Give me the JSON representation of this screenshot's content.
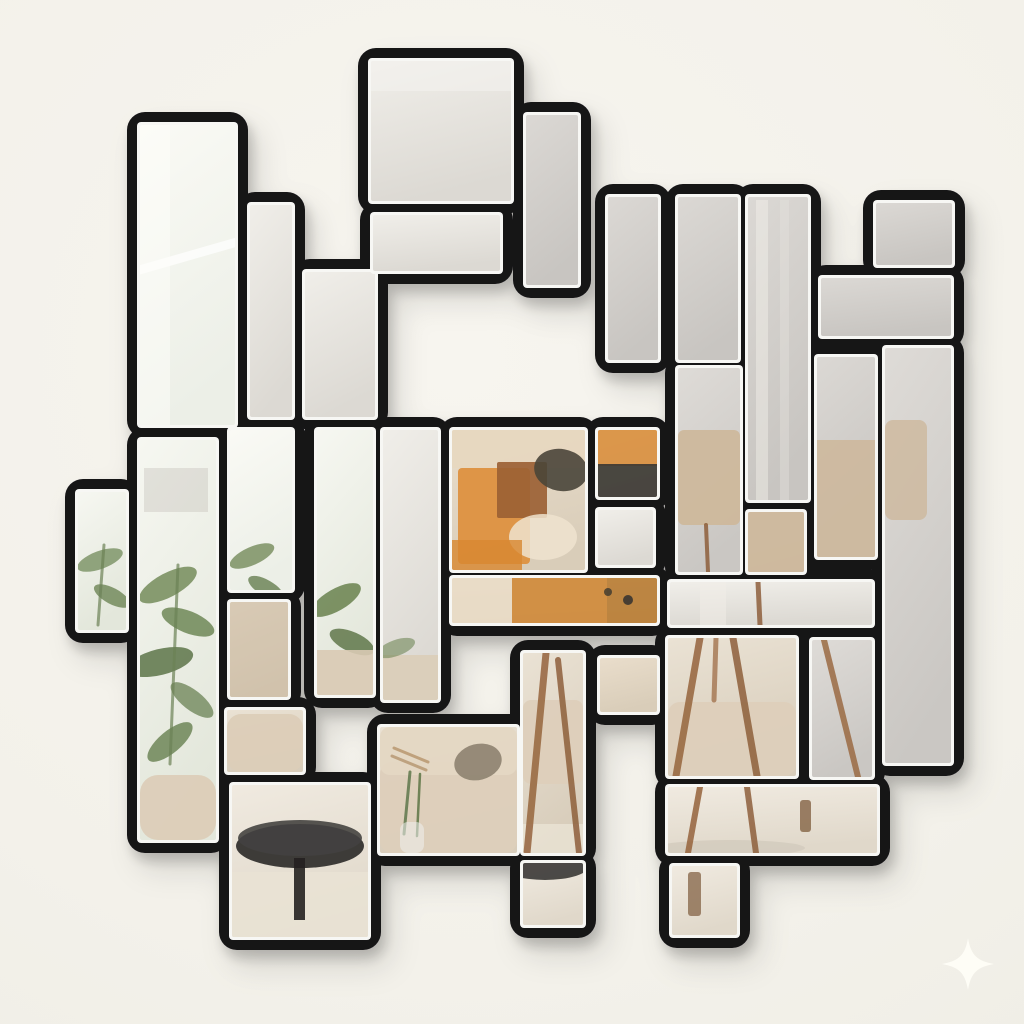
{
  "scene": {
    "description": "Tetris-style geometric wall mirror with black frames on an off-white wall, tiles reflecting a living room with plant, beige sofa, abstract orange artwork, wooden tripod floor lamp and round black coffee table",
    "wall_color": "#f3f1ea",
    "frame_color": "#141318",
    "bevel_color": "#f7f7f4",
    "shadow_color": "#000000",
    "sparkle_color": "#fffef7",
    "reflections": [
      "window light",
      "curtain",
      "city view",
      "green plant leaves",
      "beige sofa with cushions",
      "abstract orange wall art",
      "wooden tripod floor lamp with beige shade",
      "round black coffee table",
      "light wood floor and rug"
    ]
  },
  "palette": {
    "window": [
      "#fafaf5",
      "#ecefe7"
    ],
    "plantwin": [
      "#f6f7f1",
      "#e3e7db"
    ],
    "ceiling": [
      "#f0eee9",
      "#dcd9d3"
    ],
    "gray": [
      "#dbd8d4",
      "#c8c5c1"
    ],
    "lampgray": [
      "#dedbd7",
      "#cac7c3"
    ],
    "warm": [
      "#e9ddcb",
      "#d9cdb9"
    ],
    "sofa": [
      "#eae2d4",
      "#d8cdbb"
    ],
    "floor": [
      "#f0eae0",
      "#e0d8ca"
    ]
  },
  "tiles": [
    {
      "name": "tile-topleft-tall",
      "x": 140,
      "y": 125,
      "w": 95,
      "h": 300,
      "fill": "window"
    },
    {
      "name": "tile-thin-bar",
      "x": 250,
      "y": 205,
      "w": 42,
      "h": 212,
      "fill": "ceiling"
    },
    {
      "name": "tile-step-bar",
      "x": 305,
      "y": 272,
      "w": 70,
      "h": 145,
      "fill": "ceiling"
    },
    {
      "name": "tile-big-square-top",
      "x": 371,
      "y": 61,
      "w": 140,
      "h": 140,
      "fill": "ceiling"
    },
    {
      "name": "tile-horiz-under-square",
      "x": 373,
      "y": 215,
      "w": 127,
      "h": 56,
      "fill": "ceiling"
    },
    {
      "name": "tile-vert-right-of-square",
      "x": 526,
      "y": 115,
      "w": 52,
      "h": 170,
      "fill": "gray"
    },
    {
      "name": "tile-top-bar-1",
      "x": 608,
      "y": 197,
      "w": 50,
      "h": 163,
      "fill": "gray"
    },
    {
      "name": "tile-top-bar-2",
      "x": 678,
      "y": 197,
      "w": 60,
      "h": 163,
      "fill": "gray"
    },
    {
      "name": "tile-top-bar-3",
      "x": 748,
      "y": 197,
      "w": 60,
      "h": 303,
      "fill": "gray"
    },
    {
      "name": "tile-z-top-square",
      "x": 876,
      "y": 203,
      "w": 76,
      "h": 62,
      "fill": "gray"
    },
    {
      "name": "tile-z-lower-bar",
      "x": 821,
      "y": 278,
      "w": 130,
      "h": 58,
      "fill": "gray"
    },
    {
      "name": "tile-right-tall-column",
      "x": 885,
      "y": 348,
      "w": 66,
      "h": 415,
      "fill": "lampgray"
    },
    {
      "name": "tile-right-mid",
      "x": 817,
      "y": 357,
      "w": 58,
      "h": 200,
      "fill": "gray"
    },
    {
      "name": "tile-left-notch",
      "x": 78,
      "y": 492,
      "w": 48,
      "h": 138,
      "fill": "plantwin"
    },
    {
      "name": "tile-left-plant-tall",
      "x": 140,
      "y": 440,
      "w": 76,
      "h": 400,
      "fill": "plantwin"
    },
    {
      "name": "tile-left-window",
      "x": 230,
      "y": 430,
      "w": 62,
      "h": 160,
      "fill": "window"
    },
    {
      "name": "tile-plant-bar",
      "x": 317,
      "y": 430,
      "w": 56,
      "h": 265,
      "fill": "plantwin"
    },
    {
      "name": "tile-center-left-bar",
      "x": 383,
      "y": 430,
      "w": 55,
      "h": 270,
      "fill": "ceiling"
    },
    {
      "name": "tile-artwork-square",
      "x": 452,
      "y": 430,
      "w": 133,
      "h": 140,
      "fill": "warm"
    },
    {
      "name": "tile-art-right-small",
      "x": 598,
      "y": 430,
      "w": 59,
      "h": 67,
      "fill": "warm"
    },
    {
      "name": "tile-small-wall-square",
      "x": 598,
      "y": 510,
      "w": 55,
      "h": 55,
      "fill": "ceiling"
    },
    {
      "name": "tile-art-bottom-bar",
      "x": 452,
      "y": 578,
      "w": 205,
      "h": 45,
      "fill": "warm"
    },
    {
      "name": "tile-lampshade-left",
      "x": 678,
      "y": 368,
      "w": 62,
      "h": 204,
      "fill": "lampgray"
    },
    {
      "name": "tile-lampshade-small",
      "x": 748,
      "y": 512,
      "w": 56,
      "h": 60,
      "fill": "lampgray"
    },
    {
      "name": "tile-curtain-bar",
      "x": 670,
      "y": 582,
      "w": 202,
      "h": 43,
      "fill": "ceiling"
    },
    {
      "name": "tile-leather-square",
      "x": 230,
      "y": 602,
      "w": 58,
      "h": 95,
      "fill": "warm"
    },
    {
      "name": "tile-sofa-arm",
      "x": 227,
      "y": 710,
      "w": 76,
      "h": 62,
      "fill": "sofa"
    },
    {
      "name": "tile-table-square",
      "x": 232,
      "y": 785,
      "w": 136,
      "h": 152,
      "fill": "floor"
    },
    {
      "name": "tile-sofa-square",
      "x": 380,
      "y": 727,
      "w": 137,
      "h": 126,
      "fill": "sofa"
    },
    {
      "name": "tile-sofa-tripod-bar",
      "x": 523,
      "y": 653,
      "w": 60,
      "h": 200,
      "fill": "sofa"
    },
    {
      "name": "tile-floor-small-square",
      "x": 523,
      "y": 863,
      "w": 60,
      "h": 62,
      "fill": "floor"
    },
    {
      "name": "tile-leather-small",
      "x": 600,
      "y": 658,
      "w": 57,
      "h": 54,
      "fill": "warm"
    },
    {
      "name": "tile-tripod-square",
      "x": 668,
      "y": 638,
      "w": 128,
      "h": 138,
      "fill": "sofa"
    },
    {
      "name": "tile-tripod-vert",
      "x": 812,
      "y": 640,
      "w": 60,
      "h": 137,
      "fill": "lampgray"
    },
    {
      "name": "tile-floor-bar",
      "x": 668,
      "y": 787,
      "w": 209,
      "h": 66,
      "fill": "floor"
    },
    {
      "name": "tile-floor-notch",
      "x": 672,
      "y": 866,
      "w": 65,
      "h": 69,
      "fill": "floor"
    }
  ],
  "decor": [
    {
      "tile": 0,
      "kind": "rect",
      "x": 126,
      "y": 250,
      "w": 135,
      "h": 9,
      "rot": -16,
      "color": "#ffffff",
      "op": 0.7
    },
    {
      "tile": 0,
      "kind": "rect",
      "x": 140,
      "y": 125,
      "w": 30,
      "h": 300,
      "color": "#fdfdfa",
      "op": 0.5
    },
    {
      "tile": 3,
      "kind": "rect",
      "x": 371,
      "y": 61,
      "w": 140,
      "h": 30,
      "color": "#f4f2ee",
      "op": 0.6
    },
    {
      "tile": 8,
      "kind": "rect",
      "x": 756,
      "y": 200,
      "w": 12,
      "h": 300,
      "color": "#f3f1ec",
      "op": 0.45
    },
    {
      "tile": 8,
      "kind": "rect",
      "x": 780,
      "y": 200,
      "w": 9,
      "h": 300,
      "color": "#e7e4de",
      "op": 0.4
    },
    {
      "tile": 13,
      "kind": "ellipse",
      "cx": 100,
      "cy": 560,
      "rx": 24,
      "ry": 9,
      "rot": -20,
      "color": "#7f9568",
      "op": 0.85
    },
    {
      "tile": 13,
      "kind": "ellipse",
      "cx": 112,
      "cy": 596,
      "rx": 20,
      "ry": 8,
      "rot": 28,
      "color": "#6d8555",
      "op": 0.8
    },
    {
      "tile": 13,
      "kind": "line",
      "x1": 104,
      "y1": 545,
      "x2": 98,
      "y2": 625,
      "w": 3,
      "color": "#6c8256",
      "op": 0.7
    },
    {
      "tile": 14,
      "kind": "rect",
      "x": 144,
      "y": 468,
      "w": 64,
      "h": 44,
      "color": "#b6b1a8",
      "op": 0.3
    },
    {
      "tile": 14,
      "kind": "ellipse",
      "cx": 168,
      "cy": 585,
      "rx": 32,
      "ry": 12,
      "rot": -28,
      "color": "#7b9163",
      "op": 0.9
    },
    {
      "tile": 14,
      "kind": "ellipse",
      "cx": 188,
      "cy": 622,
      "rx": 28,
      "ry": 11,
      "rot": 22,
      "color": "#6f8757",
      "op": 0.85
    },
    {
      "tile": 14,
      "kind": "ellipse",
      "cx": 160,
      "cy": 662,
      "rx": 34,
      "ry": 13,
      "rot": -14,
      "color": "#5d744a",
      "op": 0.85
    },
    {
      "tile": 14,
      "kind": "ellipse",
      "cx": 192,
      "cy": 700,
      "rx": 26,
      "ry": 10,
      "rot": 38,
      "color": "#72885c",
      "op": 0.8
    },
    {
      "tile": 14,
      "kind": "ellipse",
      "cx": 170,
      "cy": 742,
      "rx": 28,
      "ry": 11,
      "rot": -40,
      "color": "#66804f",
      "op": 0.8
    },
    {
      "tile": 14,
      "kind": "line",
      "x1": 178,
      "y1": 565,
      "x2": 170,
      "y2": 764,
      "w": 3,
      "color": "#6c8256",
      "op": 0.7
    },
    {
      "tile": 14,
      "kind": "rect",
      "x": 140,
      "y": 775,
      "w": 76,
      "h": 65,
      "rx": 18,
      "color": "#dccdb8",
      "op": 0.95
    },
    {
      "tile": 15,
      "kind": "ellipse",
      "cx": 252,
      "cy": 556,
      "rx": 24,
      "ry": 9,
      "rot": -24,
      "color": "#7b9163",
      "op": 0.85
    },
    {
      "tile": 15,
      "kind": "ellipse",
      "cx": 266,
      "cy": 588,
      "rx": 20,
      "ry": 8,
      "rot": 30,
      "color": "#667e50",
      "op": 0.8
    },
    {
      "tile": 16,
      "kind": "ellipse",
      "cx": 336,
      "cy": 600,
      "rx": 28,
      "ry": 11,
      "rot": -30,
      "color": "#6f8757",
      "op": 0.9
    },
    {
      "tile": 16,
      "kind": "ellipse",
      "cx": 352,
      "cy": 642,
      "rx": 24,
      "ry": 10,
      "rot": 24,
      "color": "#5f774b",
      "op": 0.85
    },
    {
      "tile": 16,
      "kind": "rect",
      "x": 317,
      "y": 650,
      "w": 56,
      "h": 45,
      "color": "#d9cab4",
      "op": 0.9
    },
    {
      "tile": 17,
      "kind": "rect",
      "x": 383,
      "y": 655,
      "w": 55,
      "h": 45,
      "color": "#dbccb6",
      "op": 0.85
    },
    {
      "tile": 17,
      "kind": "ellipse",
      "cx": 396,
      "cy": 648,
      "rx": 20,
      "ry": 8,
      "rot": -20,
      "color": "#6f8757",
      "op": 0.6
    },
    {
      "tile": 18,
      "kind": "rect",
      "x": 452,
      "y": 430,
      "w": 133,
      "h": 38,
      "color": "#e7d7bf",
      "op": 0.9
    },
    {
      "tile": 18,
      "kind": "rect",
      "x": 458,
      "y": 468,
      "w": 72,
      "h": 96,
      "rx": 4,
      "color": "#dd9140",
      "op": 0.95
    },
    {
      "tile": 18,
      "kind": "rect",
      "x": 497,
      "y": 462,
      "w": 50,
      "h": 56,
      "rx": 2,
      "color": "#9a5f33",
      "op": 0.9
    },
    {
      "tile": 18,
      "kind": "ellipse",
      "cx": 561,
      "cy": 470,
      "rx": 27,
      "ry": 21,
      "rot": 10,
      "color": "#4a4539",
      "op": 0.9
    },
    {
      "tile": 18,
      "kind": "ellipse",
      "cx": 543,
      "cy": 537,
      "rx": 34,
      "ry": 23,
      "color": "#efe3cf",
      "op": 0.85
    },
    {
      "tile": 18,
      "kind": "rect",
      "x": 452,
      "y": 540,
      "w": 70,
      "h": 30,
      "color": "#d8872f",
      "op": 0.8
    },
    {
      "tile": 19,
      "kind": "rect",
      "x": 598,
      "y": 430,
      "w": 59,
      "h": 36,
      "color": "#d98f3e",
      "op": 0.9
    },
    {
      "tile": 19,
      "kind": "rect",
      "x": 598,
      "y": 464,
      "w": 59,
      "h": 33,
      "color": "#3d3a34",
      "op": 0.92
    },
    {
      "tile": 21,
      "kind": "rect",
      "x": 452,
      "y": 578,
      "w": 60,
      "h": 45,
      "color": "#e9dcc6",
      "op": 0.9
    },
    {
      "tile": 21,
      "kind": "rect",
      "x": 512,
      "y": 578,
      "w": 95,
      "h": 45,
      "color": "#cf8a3a",
      "op": 0.92
    },
    {
      "tile": 21,
      "kind": "rect",
      "x": 607,
      "y": 578,
      "w": 50,
      "h": 45,
      "color": "#b87c34",
      "op": 0.9
    },
    {
      "tile": 21,
      "kind": "ellipse",
      "cx": 628,
      "cy": 600,
      "rx": 5,
      "ry": 5,
      "color": "#3a362f",
      "op": 0.9
    },
    {
      "tile": 21,
      "kind": "ellipse",
      "cx": 608,
      "cy": 592,
      "rx": 4,
      "ry": 4,
      "color": "#3a362f",
      "op": 0.8
    },
    {
      "tile": 22,
      "kind": "rect",
      "x": 678,
      "y": 430,
      "w": 62,
      "h": 95,
      "rx": 6,
      "color": "#cdb89c",
      "op": 0.95
    },
    {
      "tile": 22,
      "kind": "line",
      "x1": 706,
      "y1": 525,
      "x2": 708,
      "y2": 572,
      "w": 4,
      "color": "#8e5f3b",
      "op": 0.85
    },
    {
      "tile": 23,
      "kind": "rect",
      "x": 748,
      "y": 512,
      "w": 56,
      "h": 60,
      "color": "#cdb89c",
      "op": 0.95
    },
    {
      "tile": 12,
      "kind": "rect",
      "x": 817,
      "y": 440,
      "w": 58,
      "h": 117,
      "color": "#cdb89c",
      "op": 0.9
    },
    {
      "tile": 11,
      "kind": "rect",
      "x": 885,
      "y": 420,
      "w": 42,
      "h": 100,
      "rx": 8,
      "color": "#cdb89c",
      "op": 0.8
    },
    {
      "tile": 24,
      "kind": "line",
      "x1": 758,
      "y1": 582,
      "x2": 760,
      "y2": 625,
      "w": 5,
      "color": "#8e5f3b",
      "op": 0.85
    },
    {
      "tile": 24,
      "kind": "rect",
      "x": 700,
      "y": 582,
      "w": 26,
      "h": 43,
      "color": "#f1eee8",
      "op": 0.5
    },
    {
      "tile": 25,
      "kind": "rect",
      "x": 230,
      "y": 602,
      "w": 58,
      "h": 95,
      "color": "#cbb9a2",
      "op": 0.55
    },
    {
      "tile": 26,
      "kind": "rect",
      "x": 227,
      "y": 714,
      "w": 76,
      "h": 58,
      "rx": 14,
      "color": "#dccdb8",
      "op": 0.95
    },
    {
      "tile": 27,
      "kind": "rect",
      "x": 232,
      "y": 872,
      "w": 136,
      "h": 65,
      "color": "#e9e2d4",
      "op": 0.9
    },
    {
      "tile": 27,
      "kind": "ellipse",
      "cx": 300,
      "cy": 846,
      "rx": 64,
      "ry": 22,
      "color": "#343230",
      "op": 0.95
    },
    {
      "tile": 27,
      "kind": "ellipse",
      "cx": 300,
      "cy": 838,
      "rx": 62,
      "ry": 18,
      "color": "#444240",
      "op": 0.9
    },
    {
      "tile": 27,
      "kind": "rect",
      "x": 294,
      "y": 858,
      "w": 11,
      "h": 62,
      "color": "#232221",
      "op": 0.9
    },
    {
      "tile": 28,
      "kind": "rect",
      "x": 380,
      "y": 762,
      "w": 137,
      "h": 91,
      "rx": 12,
      "color": "#ddcfba",
      "op": 0.95
    },
    {
      "tile": 28,
      "kind": "rect",
      "x": 380,
      "y": 727,
      "w": 137,
      "h": 48,
      "rx": 10,
      "color": "#e4d7c3",
      "op": 0.95
    },
    {
      "tile": 28,
      "kind": "ellipse",
      "cx": 478,
      "cy": 762,
      "rx": 24,
      "ry": 18,
      "rot": -14,
      "color": "#8d8270",
      "op": 0.9
    },
    {
      "tile": 28,
      "kind": "line",
      "x1": 394,
      "y1": 748,
      "x2": 428,
      "y2": 762,
      "w": 3,
      "color": "#b08b5f",
      "op": 0.7
    },
    {
      "tile": 28,
      "kind": "line",
      "x1": 392,
      "y1": 756,
      "x2": 426,
      "y2": 770,
      "w": 3,
      "color": "#a57f53",
      "op": 0.6
    },
    {
      "tile": 28,
      "kind": "line",
      "x1": 410,
      "y1": 772,
      "x2": 404,
      "y2": 834,
      "w": 3,
      "color": "#5f774b",
      "op": 0.85
    },
    {
      "tile": 28,
      "kind": "line",
      "x1": 420,
      "y1": 774,
      "x2": 417,
      "y2": 836,
      "w": 2.5,
      "color": "#54703f",
      "op": 0.8
    },
    {
      "tile": 28,
      "kind": "rect",
      "x": 400,
      "y": 822,
      "w": 24,
      "h": 31,
      "rx": 8,
      "color": "#eef0ee",
      "op": 0.55
    },
    {
      "tile": 29,
      "kind": "rect",
      "x": 523,
      "y": 700,
      "w": 60,
      "h": 84,
      "rx": 8,
      "color": "#ddcfba",
      "op": 0.95
    },
    {
      "tile": 29,
      "kind": "rect",
      "x": 523,
      "y": 824,
      "w": 60,
      "h": 29,
      "color": "#e8e1d2",
      "op": 0.9
    },
    {
      "tile": 29,
      "kind": "line",
      "x1": 546,
      "y1": 653,
      "x2": 527,
      "y2": 853,
      "w": 7,
      "color": "#9a6a44",
      "op": 0.9
    },
    {
      "tile": 29,
      "kind": "line",
      "x1": 558,
      "y1": 660,
      "x2": 579,
      "y2": 853,
      "w": 6,
      "color": "#8e5f3b",
      "op": 0.85
    },
    {
      "tile": 30,
      "kind": "ellipse",
      "cx": 545,
      "cy": 866,
      "rx": 44,
      "ry": 14,
      "color": "#302e2c",
      "op": 0.85
    },
    {
      "tile": 32,
      "kind": "rect",
      "x": 668,
      "y": 702,
      "w": 128,
      "h": 74,
      "rx": 12,
      "color": "#ddcfba",
      "op": 0.95
    },
    {
      "tile": 32,
      "kind": "line",
      "x1": 700,
      "y1": 638,
      "x2": 676,
      "y2": 776,
      "w": 7,
      "color": "#9a6a44",
      "op": 0.9
    },
    {
      "tile": 32,
      "kind": "line",
      "x1": 733,
      "y1": 638,
      "x2": 757,
      "y2": 776,
      "w": 7,
      "color": "#8e5f3b",
      "op": 0.85
    },
    {
      "tile": 32,
      "kind": "line",
      "x1": 716,
      "y1": 638,
      "x2": 714,
      "y2": 700,
      "w": 5,
      "color": "#a3744e",
      "op": 0.8
    },
    {
      "tile": 33,
      "kind": "line",
      "x1": 824,
      "y1": 640,
      "x2": 858,
      "y2": 777,
      "w": 6,
      "color": "#9a6a44",
      "op": 0.85
    },
    {
      "tile": 34,
      "kind": "ellipse",
      "cx": 730,
      "cy": 848,
      "rx": 75,
      "ry": 8,
      "color": "#d2cbbd",
      "op": 0.8
    },
    {
      "tile": 34,
      "kind": "line",
      "x1": 700,
      "y1": 787,
      "x2": 688,
      "y2": 853,
      "w": 6,
      "color": "#9a6a44",
      "op": 0.9
    },
    {
      "tile": 34,
      "kind": "line",
      "x1": 747,
      "y1": 787,
      "x2": 756,
      "y2": 853,
      "w": 6,
      "color": "#8e5f3b",
      "op": 0.85
    },
    {
      "tile": 34,
      "kind": "rect",
      "x": 800,
      "y": 800,
      "w": 11,
      "h": 32,
      "rx": 3,
      "color": "#8a6a4d",
      "op": 0.85
    },
    {
      "tile": 35,
      "kind": "rect",
      "x": 688,
      "y": 872,
      "w": 13,
      "h": 44,
      "rx": 3,
      "color": "#8a6a4d",
      "op": 0.8
    }
  ],
  "sparkle": {
    "path": "M968 938 C971 956 978 961 994 964 C978 967 971 972 968 990 C965 972 958 967 942 964 C958 961 965 956 968 938 Z",
    "opacity": 0.9
  }
}
